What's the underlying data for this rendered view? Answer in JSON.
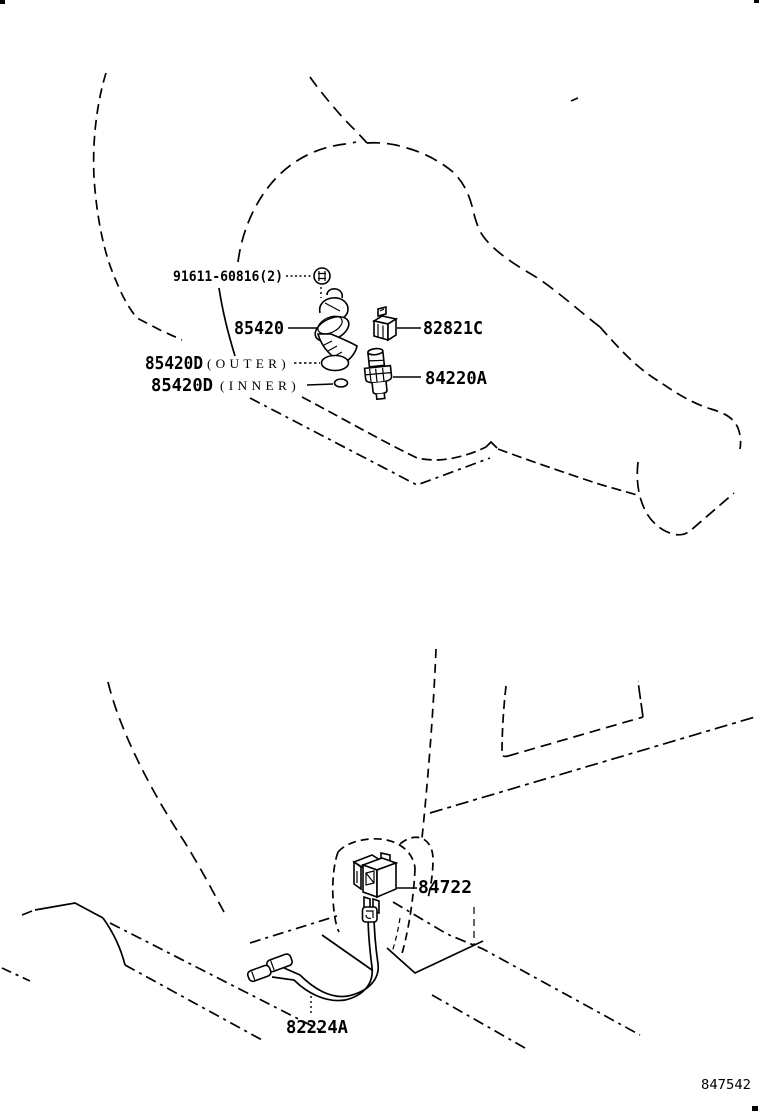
{
  "figure": {
    "number": "847542"
  },
  "upper_view": {
    "callouts": [
      {
        "id": "bolt",
        "label": "91611-60816(2)"
      },
      {
        "id": "switch-main",
        "label": "85420"
      },
      {
        "id": "cover",
        "label": "82821C"
      },
      {
        "id": "gasket-outer",
        "label": "85420D",
        "qualifier": "(OUTER)"
      },
      {
        "id": "gasket-inner",
        "label": "85420D",
        "qualifier": "(INNER)"
      },
      {
        "id": "switch-sub",
        "label": "84220A"
      }
    ]
  },
  "lower_view": {
    "callouts": [
      {
        "id": "switch-door",
        "label": "84722"
      },
      {
        "id": "wire",
        "label": "82224A"
      }
    ]
  },
  "colors": {
    "ink": "#000000",
    "paper": "#ffffff"
  }
}
